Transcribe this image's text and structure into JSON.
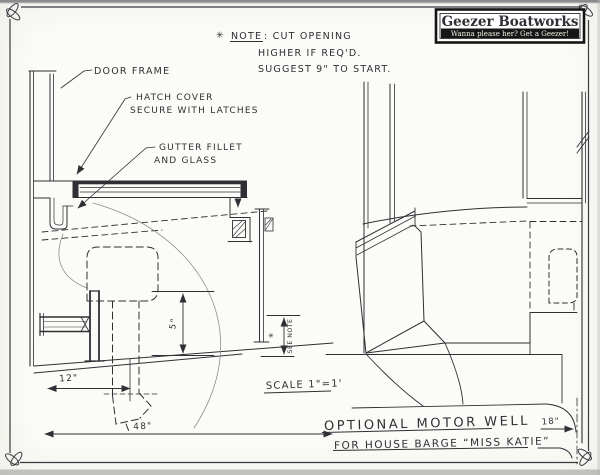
{
  "sheet": {
    "logo": {
      "title": "Geezer Boatworks",
      "tagline": "Wanna please her? Get a Geezer!"
    },
    "note": {
      "star": "✳",
      "heading": "NOTE",
      "heading_rest": ": CUT OPENING",
      "line2": "HIGHER IF REQ'D.",
      "line3": "SUGGEST 9\" TO START."
    },
    "callouts": {
      "door_frame": "DOOR FRAME",
      "hatch_cover_line1": "HATCH COVER",
      "hatch_cover_line2": "SECURE WITH LATCHES",
      "gutter_line1": "GUTTER FILLET",
      "gutter_line2": "AND GLASS"
    },
    "dimensions": {
      "well_floor_width": "12\"",
      "overall_width": "48\"",
      "motor_shaft": "5\"",
      "see_note_star": "✳",
      "see_note": "SEE NOTE",
      "stern_depth": "18\""
    },
    "scale_label": "SCALE 1\"=1'",
    "title_block": {
      "line1": "OPTIONAL MOTOR WELL",
      "line2": "FOR HOUSE BARGE “MISS KATIE”"
    }
  },
  "colors": {
    "ink": "#2f2f36",
    "light_stroke": "#8c8c92",
    "paper": "#fbfbf7"
  }
}
